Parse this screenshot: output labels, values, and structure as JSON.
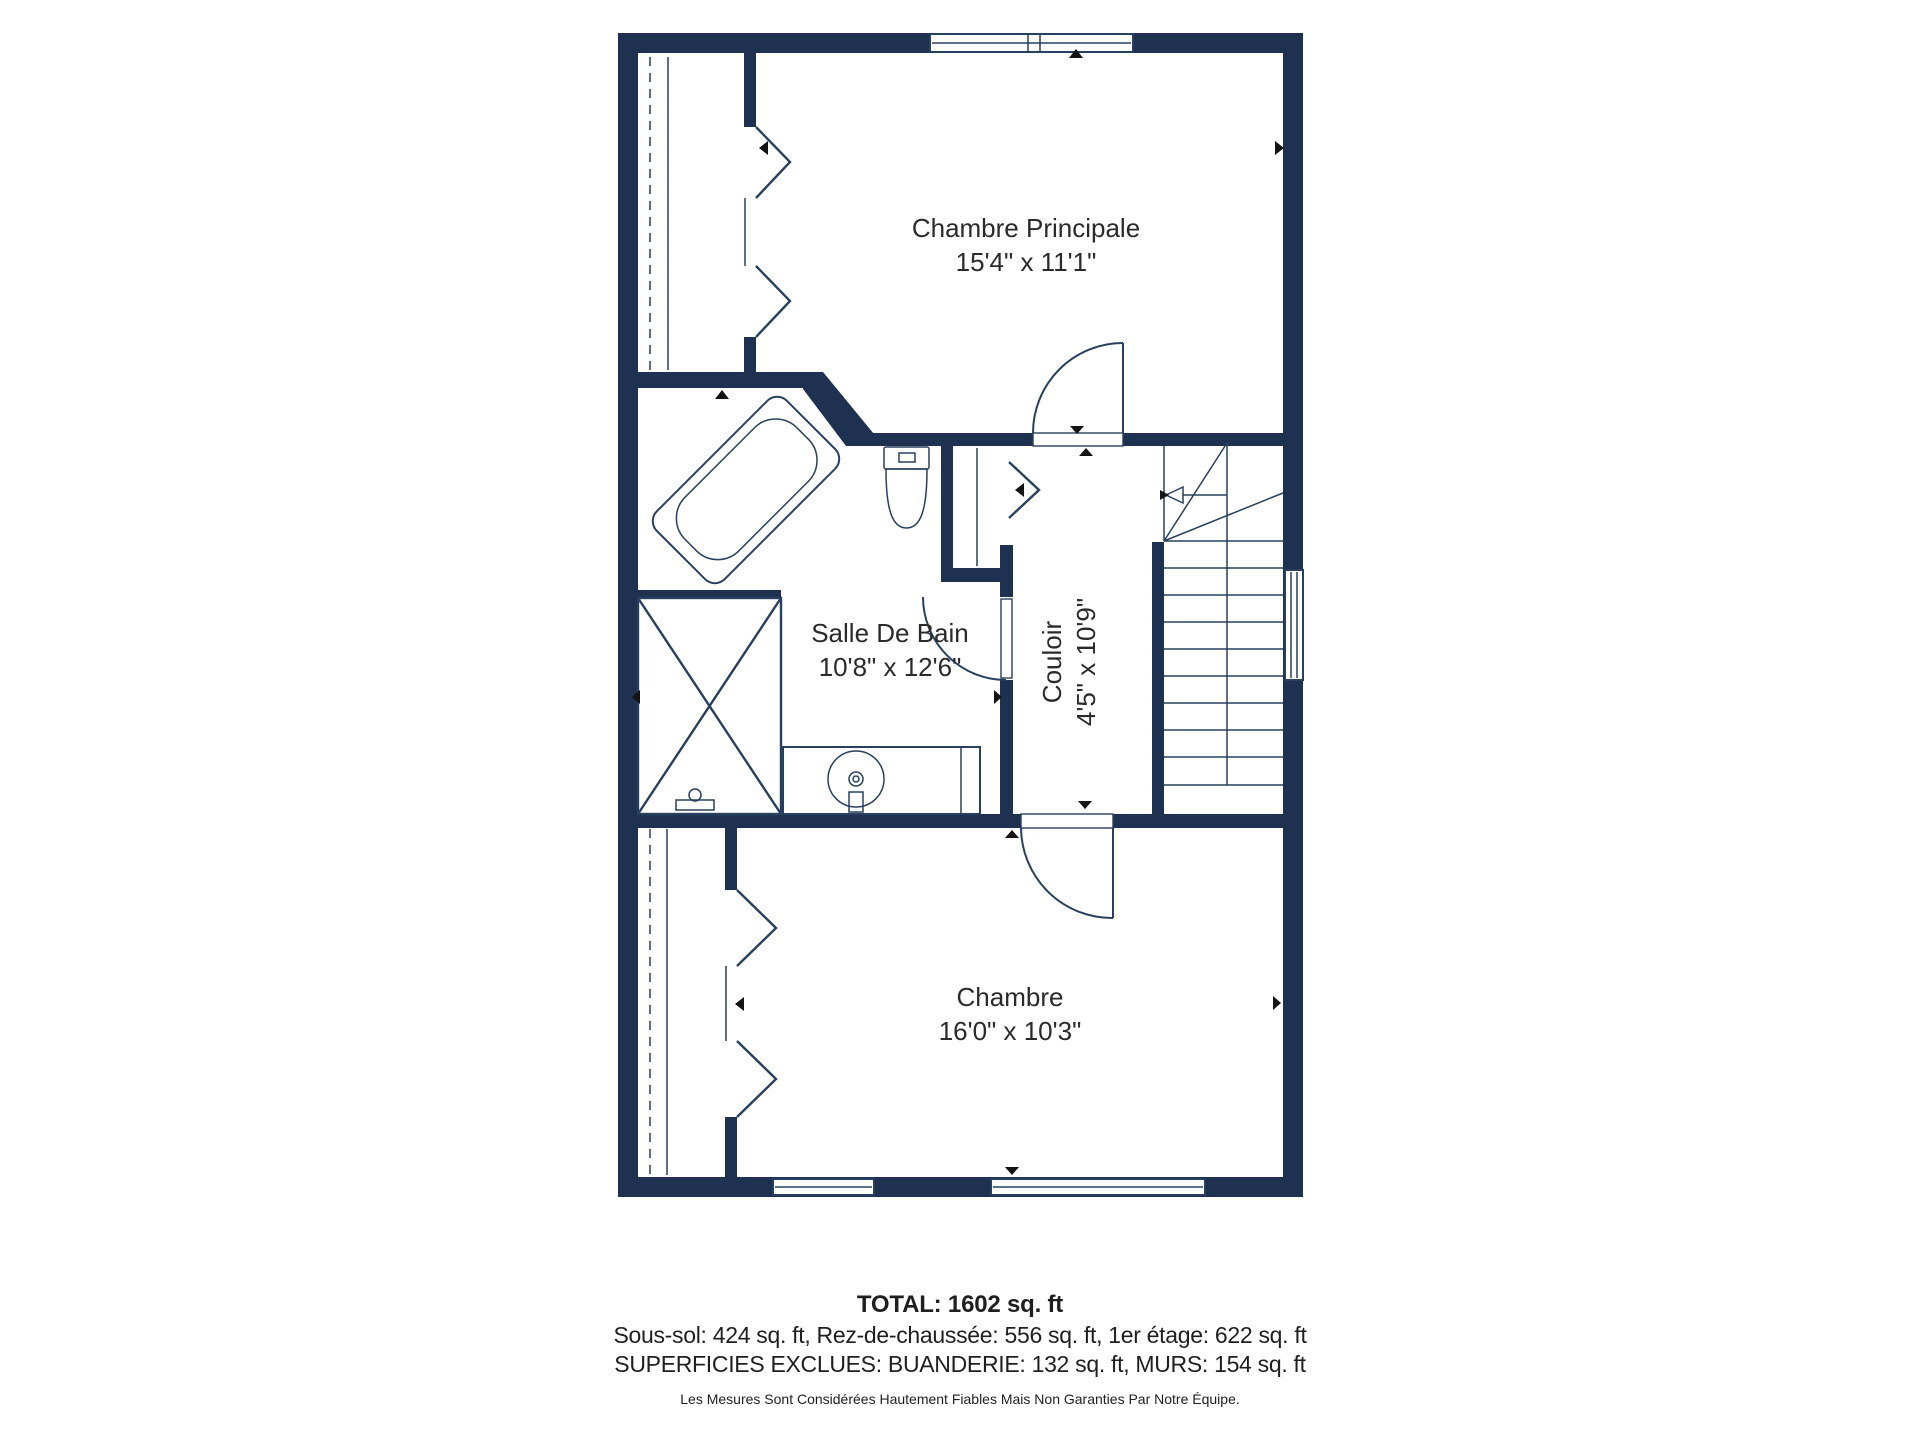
{
  "floorplan": {
    "rooms": [
      {
        "id": "chambre-principale",
        "name": "Chambre Principale",
        "dims": "15'4\" x 11'1\""
      },
      {
        "id": "salle-de-bain",
        "name": "Salle De Bain",
        "dims": "10'8\" x 12'6\""
      },
      {
        "id": "couloir",
        "name": "Couloir",
        "dims": "4'5\" x 10'9\""
      },
      {
        "id": "chambre",
        "name": "Chambre",
        "dims": "16'0\" x 10'3\""
      }
    ],
    "colors": {
      "wall": "#1e3150",
      "line": "#28405f",
      "marker": "#141414",
      "label": "#2a2a2a"
    }
  },
  "summary": {
    "total": "TOTAL: 1602 sq. ft",
    "floors": "Sous-sol: 424 sq. ft, Rez-de-chaussée: 556 sq. ft, 1er étage: 622 sq. ft",
    "exclusions": "SUPERFICIES EXCLUES: BUANDERIE: 132 sq. ft, MURS: 154 sq. ft",
    "disclaimer": "Les Mesures Sont Considérées Hautement Fiables Mais Non Garanties Par Notre Équipe."
  }
}
